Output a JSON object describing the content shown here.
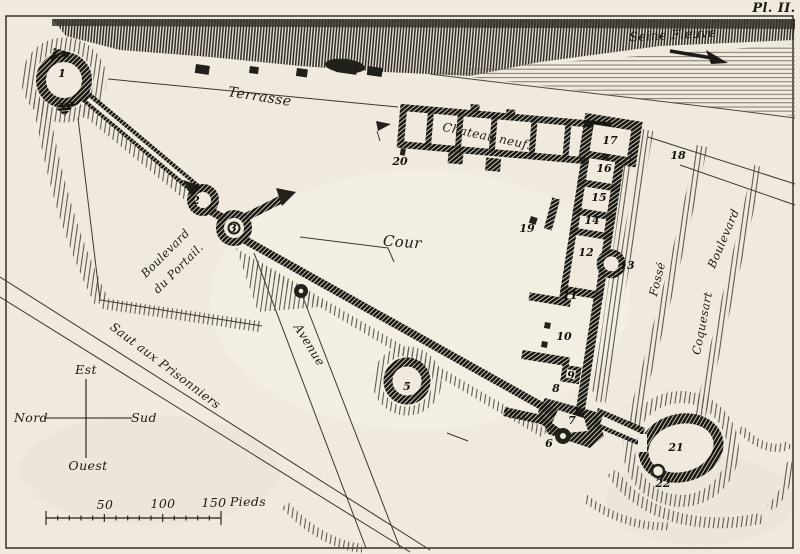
{
  "plate_label": "Pl. II.",
  "labels": {
    "seine": "Seine Fleuve",
    "terrasse": "Terrasse",
    "chateau_neuf": "Chateau neuf.",
    "cour": "Cour",
    "boulevard_portail_1": "Boulevard",
    "boulevard_portail_2": "du Portail.",
    "avenue": "Avenue",
    "saut_aux_prisonniers": "Saut aux Prisonniers",
    "fosse": "Fossé",
    "boulevard_coquesart_1": "Boulevard",
    "boulevard_coquesart_2": "Coquesart"
  },
  "compass": {
    "top": "Est",
    "left": "Nord",
    "right": "Sud",
    "bottom": "Ouest"
  },
  "scale_bar": {
    "tick_50": "50",
    "tick_100": "100",
    "tick_150": "150",
    "unit": "Pieds"
  },
  "markers": [
    "1",
    "2",
    "3",
    "5",
    "6",
    "7",
    "8",
    "9",
    "10",
    "11",
    "12",
    "13",
    "14",
    "15",
    "16",
    "17",
    "18",
    "19",
    "20",
    "21",
    "22"
  ],
  "colors": {
    "paper": "#efeadd",
    "ink": "#1d1b16"
  }
}
